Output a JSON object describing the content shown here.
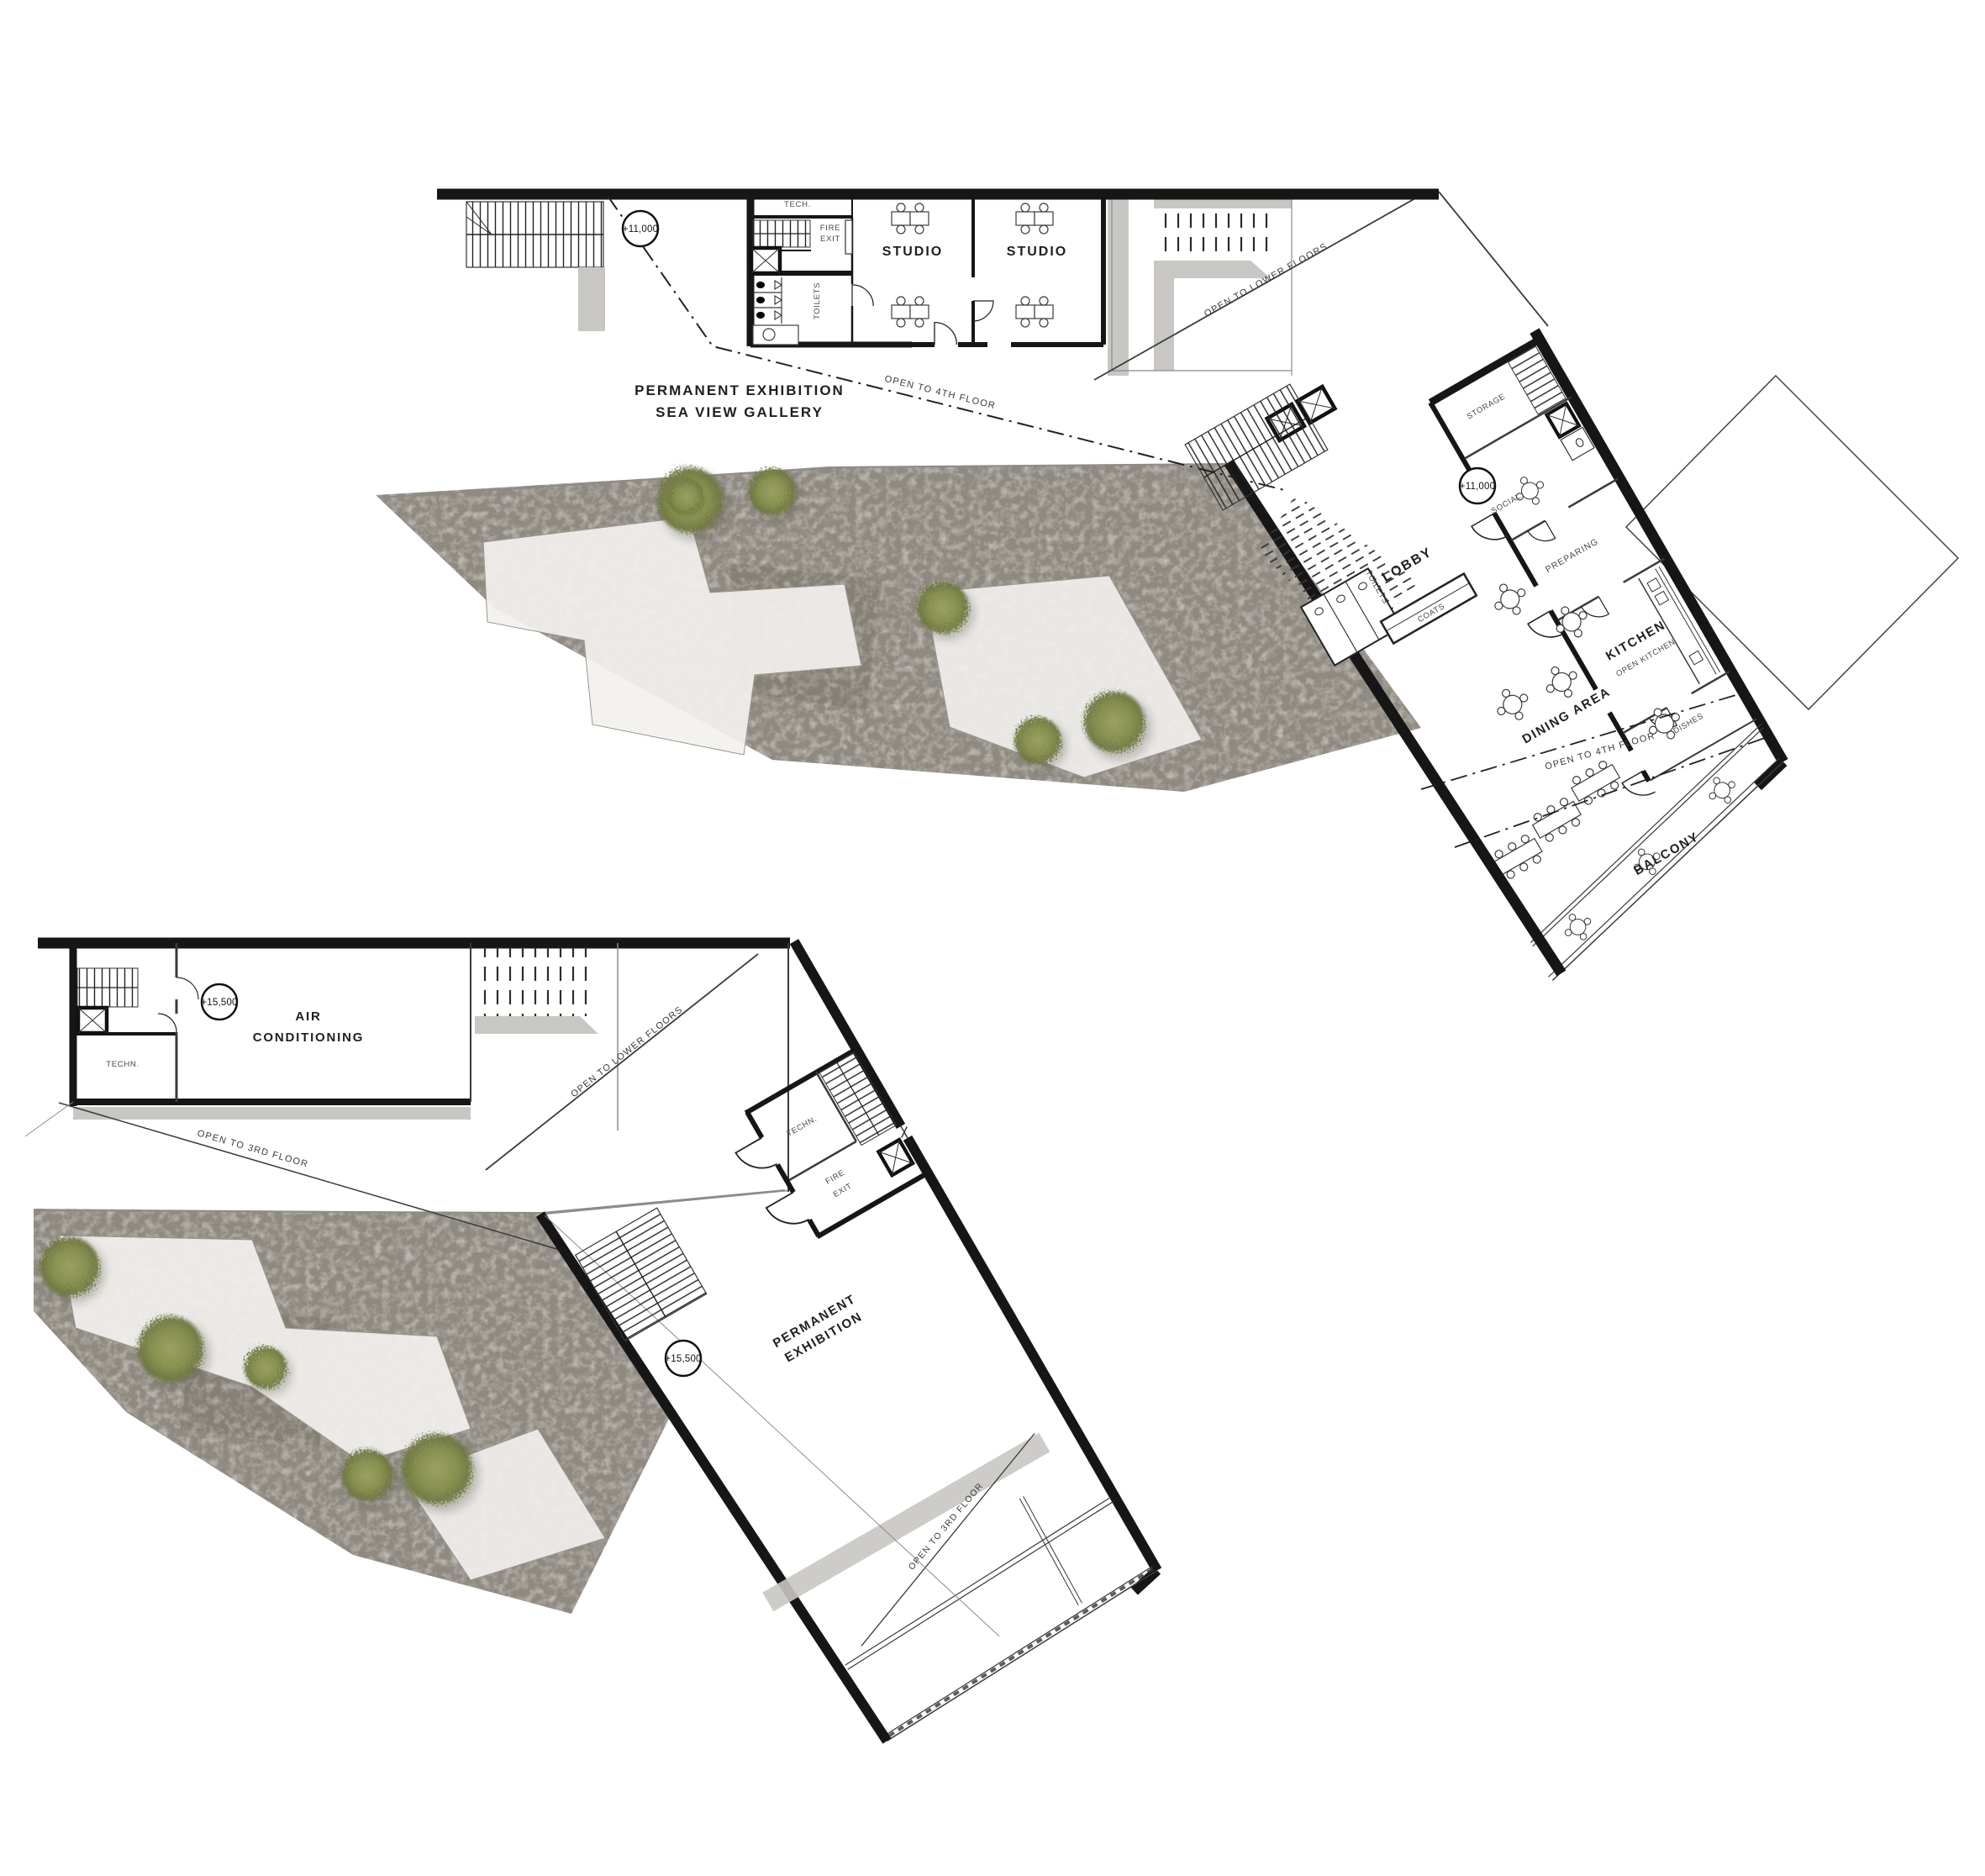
{
  "colors": {
    "wall": "#161616",
    "gray_walkway": "#c9c7c3",
    "plaza_base": "#d4d1cb",
    "plaza_light": "#f2f1ee",
    "tree_green": "#8b935a",
    "annotation_text": "#474747"
  },
  "upper_plan": {
    "level_marker": "+11,000",
    "labels": {
      "tech": "TECH.",
      "fire_line1": "FIRE",
      "fire_line2": "EXIT",
      "toilets_west": "TOILETS",
      "studio_1": "STUDIO",
      "studio_2": "STUDIO",
      "gallery_line1": "PERMANENT EXHIBITION",
      "gallery_line2": "SEA VIEW GALLERY",
      "storage": "STORAGE",
      "social": "SOCIAL",
      "preparing": "PREPARING",
      "kitchen": "KITCHEN",
      "open_kitchen": "OPEN KITCHEN",
      "dishes": "DISHES",
      "lobby": "LOBBY",
      "toilets_east": "TOILETS",
      "coats": "COATS",
      "dining_area": "DINING AREA",
      "balcony": "BALCONY"
    },
    "annotations": {
      "level_a": "+11,000",
      "level_b": "+11,000",
      "open_to_4th_gallery": "OPEN TO 4TH FLOOR",
      "open_to_4th_dining": "OPEN TO 4TH FLOOR",
      "open_to_lower_floors": "OPEN TO LOWER FLOORS"
    }
  },
  "lower_plan": {
    "level_marker": "+15,500",
    "labels": {
      "air_line1": "AIR",
      "air_line2": "CONDITIONING",
      "techn_west": "TECHN.",
      "techn_wing": "TECHN.",
      "fire_line1": "FIRE",
      "fire_line2": "EXIT",
      "exhibition_line1": "PERMANENT",
      "exhibition_line2": "EXHIBITION"
    },
    "annotations": {
      "level_a": "+15,500",
      "level_b": "+15,500",
      "open_to_3rd_a": "OPEN TO 3RD FLOOR",
      "open_to_3rd_b": "OPEN TO 3RD FLOOR",
      "open_to_lower_floors": "OPEN TO LOWER FLOORS"
    }
  }
}
